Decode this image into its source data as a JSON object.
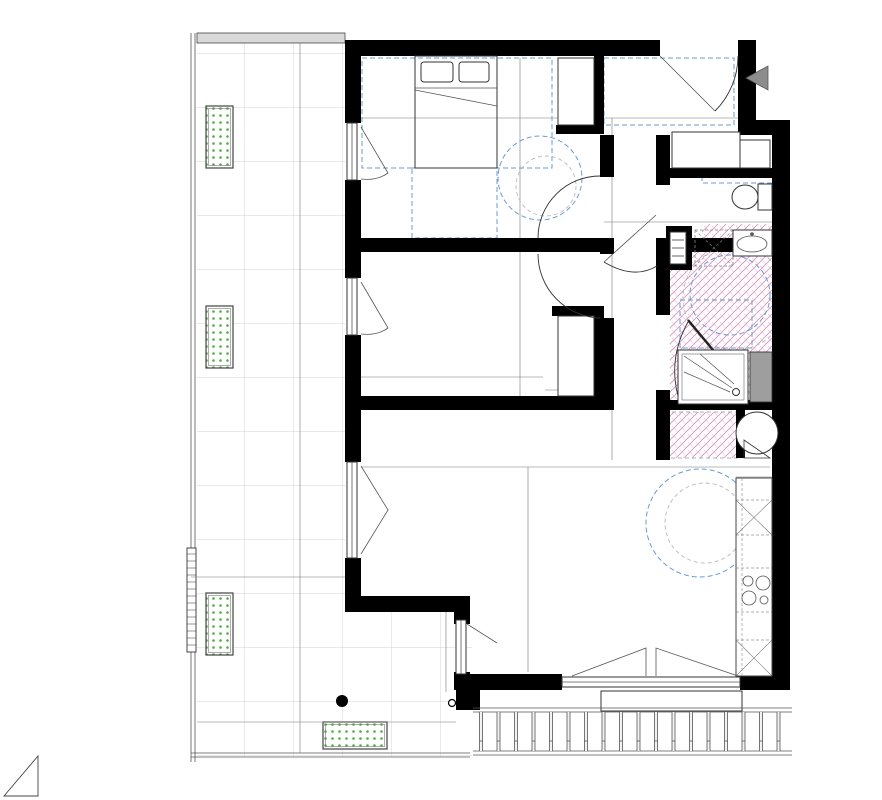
{
  "title": "PLAN PROVISOIRE",
  "unit": {
    "type": "T3",
    "code": "A066"
  },
  "rooms": {
    "chambre1": "Chambre 1",
    "chambre2": "Chambre 2",
    "entree": "Entrée",
    "wc": "Wc",
    "sde": "SDE",
    "sejour": "Séjour/cuisine",
    "balcon": "Balcon"
  },
  "notes": {
    "hsd": "HSD : 2.60m",
    "hs_fp": "Hs FP : 2.35m",
    "hs_s": "Hs S : 2.35m"
  },
  "labels": {
    "pare_vue": "PARE-VUE",
    "gcv": "GCV",
    "jardiniere": "Jardinière",
    "brise_v": "Brise soleil",
    "brise_h": "Brise Soleil horizontal",
    "pl": "PL",
    "cd": "CD",
    "pf": "PF",
    "vre": "VRE",
    "pfc2v": "PFC-2V",
    "level_out": "+0.10",
    "level_in": "+0.00",
    "bay": "F 2V-All V 2V",
    "fridge": "F",
    "ballon1": "BALLON",
    "ballon2": "THERMODYNAMIQUE"
  },
  "dims": {
    "ch1_w": "3.36",
    "ch1_h": "3.10",
    "ch2_w": "3.36",
    "ch2_h": "2.85",
    "pl1_h": "1.38",
    "pl1_w": "0.65",
    "pl2_h": "1.30",
    "pl2_w": "0.65",
    "pl_entree": "0.55",
    "entree_w": "2.22",
    "entree_door": "1.27",
    "hall_l": "4.38",
    "hall_w": "1.16",
    "wc_d": "0.93",
    "wc_w": "1.47",
    "sde_w": "1.47",
    "sde_diag": "2.90",
    "sejour_w": "7.06",
    "sejour_h": "4.63",
    "kitchen_l": "3.75",
    "kitchen_w": "0.65",
    "ballon_d": "0.80",
    "balcon_l": "9.44",
    "balcon_w1": "2.12",
    "balcon_w2": "4.15",
    "corner_win": "2.34"
  },
  "colors": {
    "title_red": "#e8262e",
    "ceiling_blue": "#6b9bd2",
    "hatch_pink": "#d990bd",
    "plant_green": "#4caf3e"
  }
}
